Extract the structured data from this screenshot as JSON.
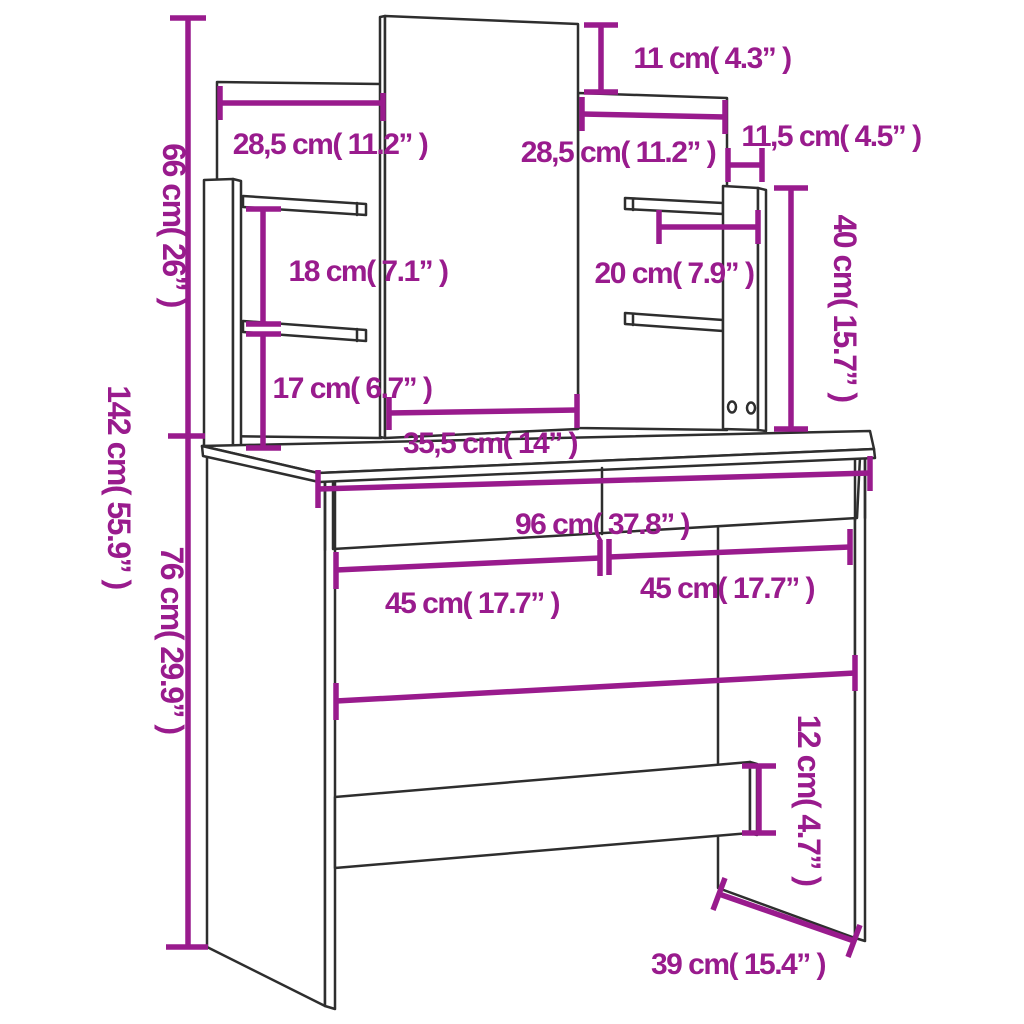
{
  "title": "Dressing table with mirror and shelves - dimension diagram",
  "colors": {
    "dimension_accent": "#991b8d",
    "outline": "#2e2e2e",
    "background": "#ffffff"
  },
  "labels": {
    "total_height": "142 cm( 55.9” )",
    "upper_height": "66 cm( 26” )",
    "desk_height": "76 cm( 29.9” )",
    "mirror_top_offset": "11 cm( 4.3” )",
    "left_panel_width": "28,5 cm( 11.2” )",
    "right_panel_width": "28,5 cm( 11.2” )",
    "top_side_depth": "11,5 cm( 4.5” )",
    "right_column_height": "40 cm( 15.7” )",
    "left_shelf_gap": "18 cm( 7.1” )",
    "right_shelf_width": "20 cm( 7.9” )",
    "lower_shelf_gap": "17 cm( 6.7” )",
    "mirror_width": "35,5 cm( 14” )",
    "desk_width": "96 cm( 37.8” )",
    "drawer_left_width": "45 cm( 17.7” )",
    "drawer_right_width": "45 cm( 17.7” )",
    "beam_height": "12 cm( 4.7” )",
    "leg_depth": "39 cm( 15.4” )"
  },
  "measurements": [
    {
      "cm": "142",
      "inches": "55.9",
      "what": "total height"
    },
    {
      "cm": "66",
      "inches": "26",
      "what": "upper unit height"
    },
    {
      "cm": "76",
      "inches": "29.9",
      "what": "desk height"
    },
    {
      "cm": "96",
      "inches": "37.8",
      "what": "desk width"
    },
    {
      "cm": "39",
      "inches": "15.4",
      "what": "depth"
    },
    {
      "cm": "35,5",
      "inches": "14",
      "what": "mirror width"
    },
    {
      "cm": "28,5",
      "inches": "11.2",
      "what": "left back panel width"
    },
    {
      "cm": "28,5",
      "inches": "11.2",
      "what": "right back panel width"
    },
    {
      "cm": "11",
      "inches": "4.3",
      "what": "mirror top offset"
    },
    {
      "cm": "11,5",
      "inches": "4.5",
      "what": "top side depth"
    },
    {
      "cm": "40",
      "inches": "15.7",
      "what": "right column height"
    },
    {
      "cm": "20",
      "inches": "7.9",
      "what": "right shelf width"
    },
    {
      "cm": "18",
      "inches": "7.1",
      "what": "left shelf gap"
    },
    {
      "cm": "17",
      "inches": "6.7",
      "what": "lower shelf gap"
    },
    {
      "cm": "45",
      "inches": "17.7",
      "what": "left drawer width"
    },
    {
      "cm": "45",
      "inches": "17.7",
      "what": "right drawer width"
    },
    {
      "cm": "12",
      "inches": "4.7",
      "what": "stretcher beam height"
    }
  ]
}
